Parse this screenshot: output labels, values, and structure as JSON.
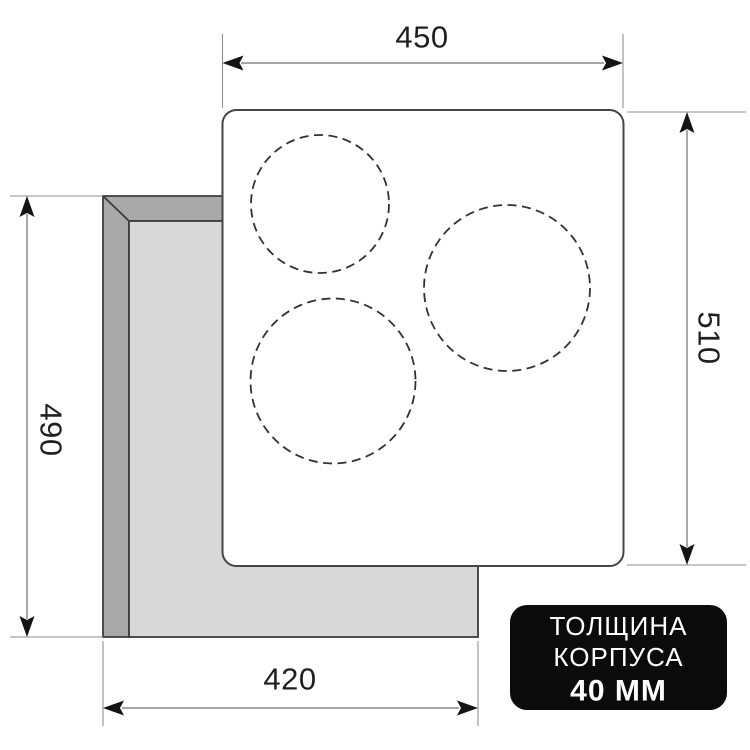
{
  "diagram": {
    "title_semantic": "cooktop-installation-dimensions",
    "dimensions": {
      "width_top": "450",
      "height_right": "510",
      "height_left": "490",
      "width_bottom": "420"
    },
    "badge": {
      "line1": "ТОЛЩИНА",
      "line2": "КОРПУСА",
      "line3": "40 ММ"
    },
    "colors": {
      "cutout_wall": "#a9a9a9",
      "cutout_inner": "#d8d8d8",
      "outline": "#3d3d3d",
      "dimension_line": "#6f6f6f",
      "extension_line": "#8f8f8f",
      "arrow": "#141414",
      "label_text": "#1f1f1f",
      "panel_fill": "#ffffff",
      "panel_border": "#454545",
      "zone_dash": "#323232",
      "badge_bg": "#0b0b0b",
      "badge_text": "#ffffff"
    }
  }
}
